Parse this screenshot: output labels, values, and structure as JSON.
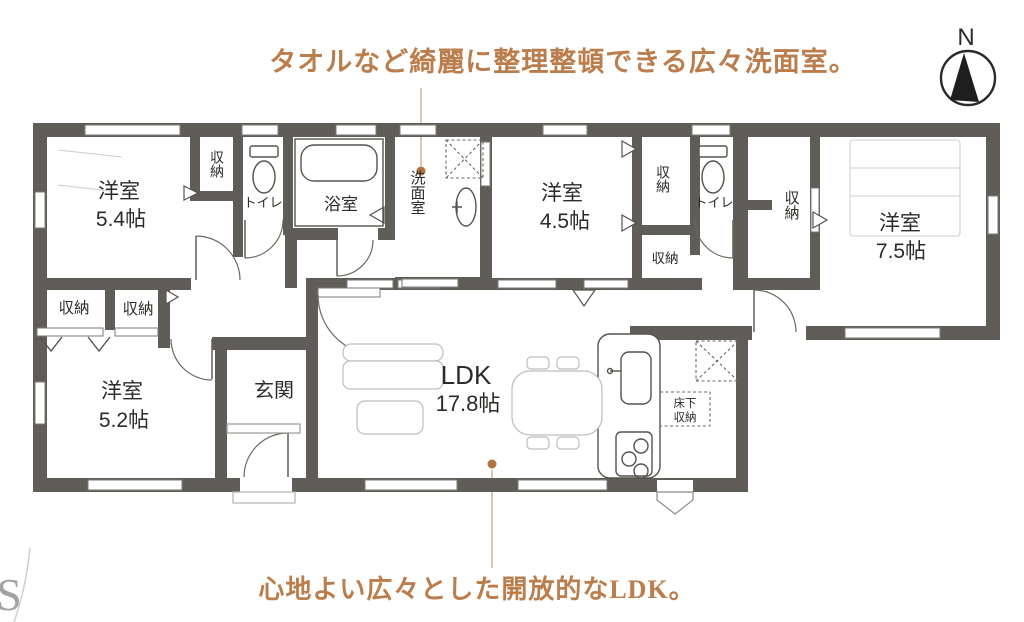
{
  "annotations": {
    "top": "タオルなど綺麗に整理整頓できる広々洗面室。",
    "bottom": "心地よい広々とした開放的なLDK。"
  },
  "compass": {
    "label": "N"
  },
  "watermark": {
    "text": "S"
  },
  "colors": {
    "wall": "#605d58",
    "annotation_text": "#bb7d4b",
    "leader_dot": "#b5713f",
    "fixture_line": "#56534e",
    "furniture_line": "#bdbdbd"
  },
  "rooms": {
    "bedroom_5_4": {
      "name": "洋室",
      "size": "5.4帖"
    },
    "bedroom_4_5": {
      "name": "洋室",
      "size": "4.5帖"
    },
    "bedroom_7_5": {
      "name": "洋室",
      "size": "7.5帖"
    },
    "bedroom_5_2": {
      "name": "洋室",
      "size": "5.2帖"
    },
    "ldk": {
      "name": "LDK",
      "size": "17.8帖"
    },
    "entrance": {
      "name": "玄関"
    },
    "bath": {
      "name": "浴室"
    },
    "washroom": {
      "name": "洗面室"
    },
    "toilet": {
      "name": "トイレ"
    },
    "closet": {
      "name": "収納"
    },
    "underfloor_storage": {
      "name": "床下収納",
      "line1": "床下",
      "line2": "収納"
    }
  }
}
